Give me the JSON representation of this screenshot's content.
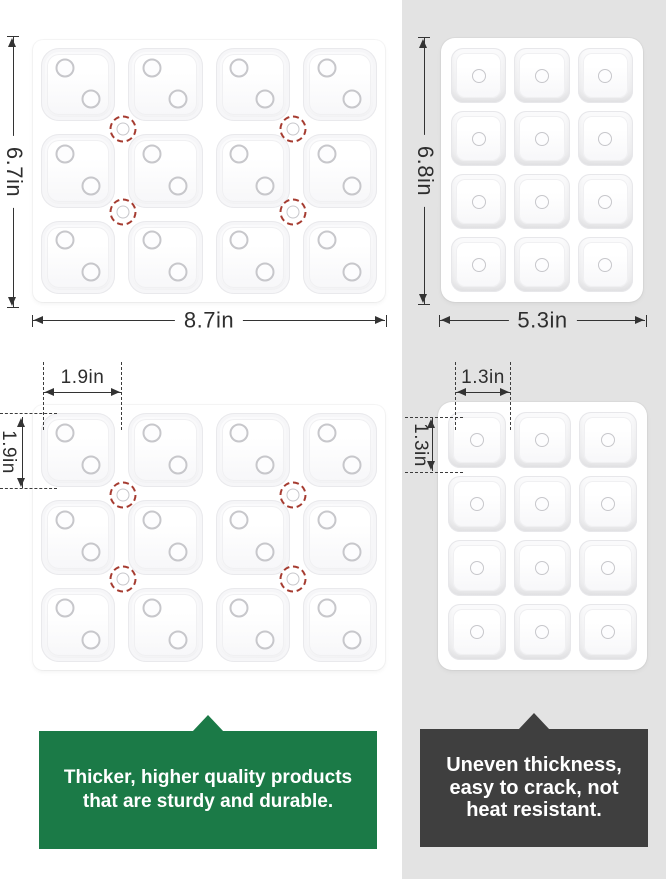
{
  "colors": {
    "good_callout_bg": "#1b7a47",
    "bad_callout_bg": "#3f3f3f",
    "panel_gray": "#e3e3e3",
    "dimension_ink": "#333333",
    "marker_red": "#a63c31"
  },
  "dimensions": {
    "good_tray": {
      "width": "8.7in",
      "height": "6.7in",
      "cell_width": "1.9in",
      "cell_height": "1.9in"
    },
    "bad_tray": {
      "width": "5.3in",
      "height": "6.8in",
      "cell_width": "1.3in",
      "cell_height": "1.3in"
    }
  },
  "callouts": {
    "good": {
      "lines": [
        "Thicker, higher quality products",
        "that are sturdy and durable."
      ]
    },
    "bad": {
      "lines": [
        "Uneven thickness,",
        "easy to crack, not",
        "heat resistant."
      ]
    }
  },
  "trays": {
    "top_left": {
      "cols": 4,
      "rows": 3,
      "dot_positions": [
        [
          32,
          27
        ],
        [
          67,
          70
        ]
      ],
      "red_markers": [
        [
          25.6,
          34
        ],
        [
          73.9,
          34
        ],
        [
          25.6,
          65.5
        ],
        [
          73.9,
          65.5
        ]
      ]
    },
    "top_right": {
      "cols": 3,
      "rows": 4,
      "dot_positions": [
        [
          50,
          50
        ]
      ],
      "red_markers": []
    },
    "bottom_left": {
      "cols": 4,
      "rows": 3,
      "dot_positions": [
        [
          32,
          27
        ],
        [
          67,
          70
        ]
      ],
      "red_markers": [
        [
          25.6,
          34
        ],
        [
          73.9,
          34
        ],
        [
          25.6,
          65.5
        ],
        [
          73.9,
          65.5
        ]
      ]
    },
    "bottom_right": {
      "cols": 3,
      "rows": 4,
      "dot_positions": [
        [
          50,
          50
        ]
      ],
      "red_markers": []
    }
  }
}
